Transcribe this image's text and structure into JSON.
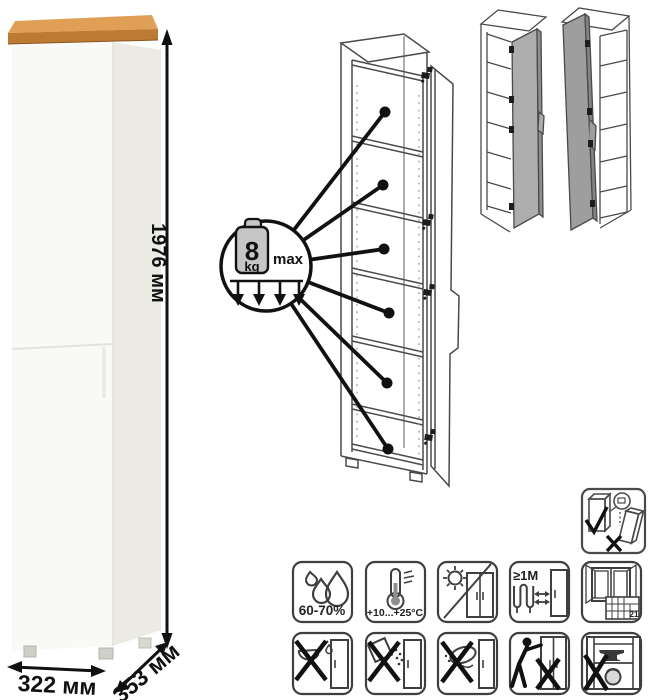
{
  "product": {
    "kind": "tall single-door cabinet product sheet",
    "shelf_count": 6,
    "colors": {
      "body_front": "#f9f9f6",
      "body_side": "#ebebe4",
      "wood_top": "#dfa055",
      "wood_top_edge": "#bd7a33",
      "line_art": "#4a4a4a",
      "door_fill_left_variant": "#adadad",
      "door_fill_right_variant": "#9e9e9e",
      "annotation": "#111111"
    }
  },
  "dimensions": {
    "height_label": "1976 мм",
    "width_label": "322 мм",
    "depth_label": "353 мм"
  },
  "shelf_load": {
    "value": "8",
    "unit": "kg",
    "qualifier": "max"
  },
  "variants": {
    "left": "door hinged right",
    "right": "door hinged left"
  },
  "safety": {
    "wall_anchor": "secure cabinet to wall"
  },
  "care_icons": {
    "row1": [
      {
        "name": "humidity-icon",
        "label": "60-70%"
      },
      {
        "name": "temperature-icon",
        "label": "+10...+25°C"
      },
      {
        "name": "no-direct-sunlight-icon",
        "label": ""
      },
      {
        "name": "heat-distance-icon",
        "label": "≥1М"
      },
      {
        "name": "ventilation-icon",
        "label": "21"
      }
    ],
    "row2": [
      {
        "name": "no-liquids-icon"
      },
      {
        "name": "no-abrasive-powder-icon"
      },
      {
        "name": "no-wet-sponge-icon"
      },
      {
        "name": "no-dragging-icon"
      },
      {
        "name": "no-heavy-items-icon"
      }
    ]
  }
}
